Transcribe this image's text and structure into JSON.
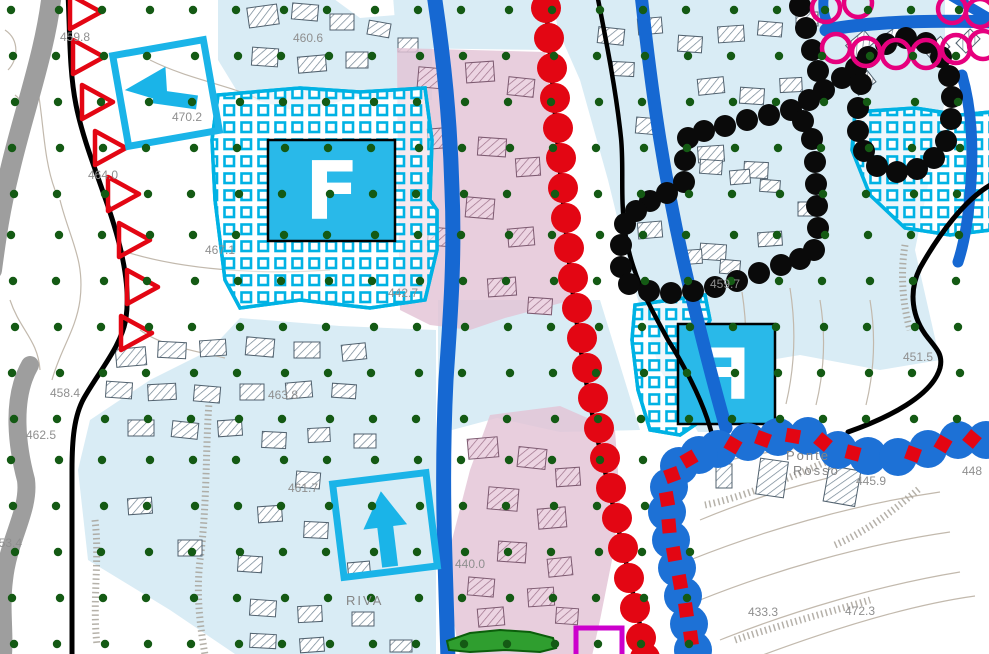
{
  "map": {
    "labels": [
      {
        "text": "459.8",
        "x": 60,
        "y": 30,
        "kind": "elevation"
      },
      {
        "text": "460.6",
        "x": 293,
        "y": 31,
        "kind": "elevation"
      },
      {
        "text": "470.2",
        "x": 172,
        "y": 110,
        "kind": "elevation"
      },
      {
        "text": "464.0",
        "x": 88,
        "y": 168,
        "kind": "elevation"
      },
      {
        "text": "467.1",
        "x": 205,
        "y": 243,
        "kind": "elevation"
      },
      {
        "text": "442.7",
        "x": 388,
        "y": 286,
        "kind": "elevation"
      },
      {
        "text": "459.7",
        "x": 710,
        "y": 277,
        "kind": "elevation"
      },
      {
        "text": "451.5",
        "x": 903,
        "y": 350,
        "kind": "elevation"
      },
      {
        "text": "458.4",
        "x": 50,
        "y": 386,
        "kind": "elevation"
      },
      {
        "text": "462.5",
        "x": 26,
        "y": 428,
        "kind": "elevation"
      },
      {
        "text": "463.8",
        "x": 268,
        "y": 388,
        "kind": "elevation"
      },
      {
        "text": "453.4",
        "x": -8,
        "y": 536,
        "kind": "elevation"
      },
      {
        "text": "461.7",
        "x": 288,
        "y": 481,
        "kind": "elevation"
      },
      {
        "text": "440.0",
        "x": 455,
        "y": 557,
        "kind": "elevation"
      },
      {
        "text": "445.9",
        "x": 856,
        "y": 474,
        "kind": "elevation"
      },
      {
        "text": "448",
        "x": 962,
        "y": 464,
        "kind": "elevation"
      },
      {
        "text": "433.3",
        "x": 748,
        "y": 605,
        "kind": "elevation"
      },
      {
        "text": "472.3",
        "x": 845,
        "y": 604,
        "kind": "elevation"
      },
      {
        "text": "RIVA",
        "x": 346,
        "y": 593,
        "kind": "place"
      },
      {
        "text": "Ponte",
        "x": 786,
        "y": 448,
        "kind": "place"
      },
      {
        "text": "Rosso",
        "x": 793,
        "y": 463,
        "kind": "place"
      }
    ],
    "zone_boxes": [
      {
        "letter": "F",
        "mirrored": false
      },
      {
        "letter": "F",
        "mirrored": true
      }
    ],
    "arrows": [
      {
        "direction": "left"
      },
      {
        "direction": "up"
      }
    ],
    "colors": {
      "zone_f_fill": "#29b9e9",
      "zone_f_pattern": "#00b2e4",
      "constraint_dot_green": "#145a14",
      "river_road_blue": "#1668d2",
      "boundary_red": "#e30613",
      "scallop_magenta": "#e6007e",
      "zone_pink": "#e3c3d6",
      "zone_pale_blue": "#d9ecf5",
      "terrain_gray_band": "#9e9e9e",
      "magenta_box": "#cc00cc",
      "green_area": "#2f9e2f",
      "black_dot_chain": "#0a0a0a"
    }
  }
}
